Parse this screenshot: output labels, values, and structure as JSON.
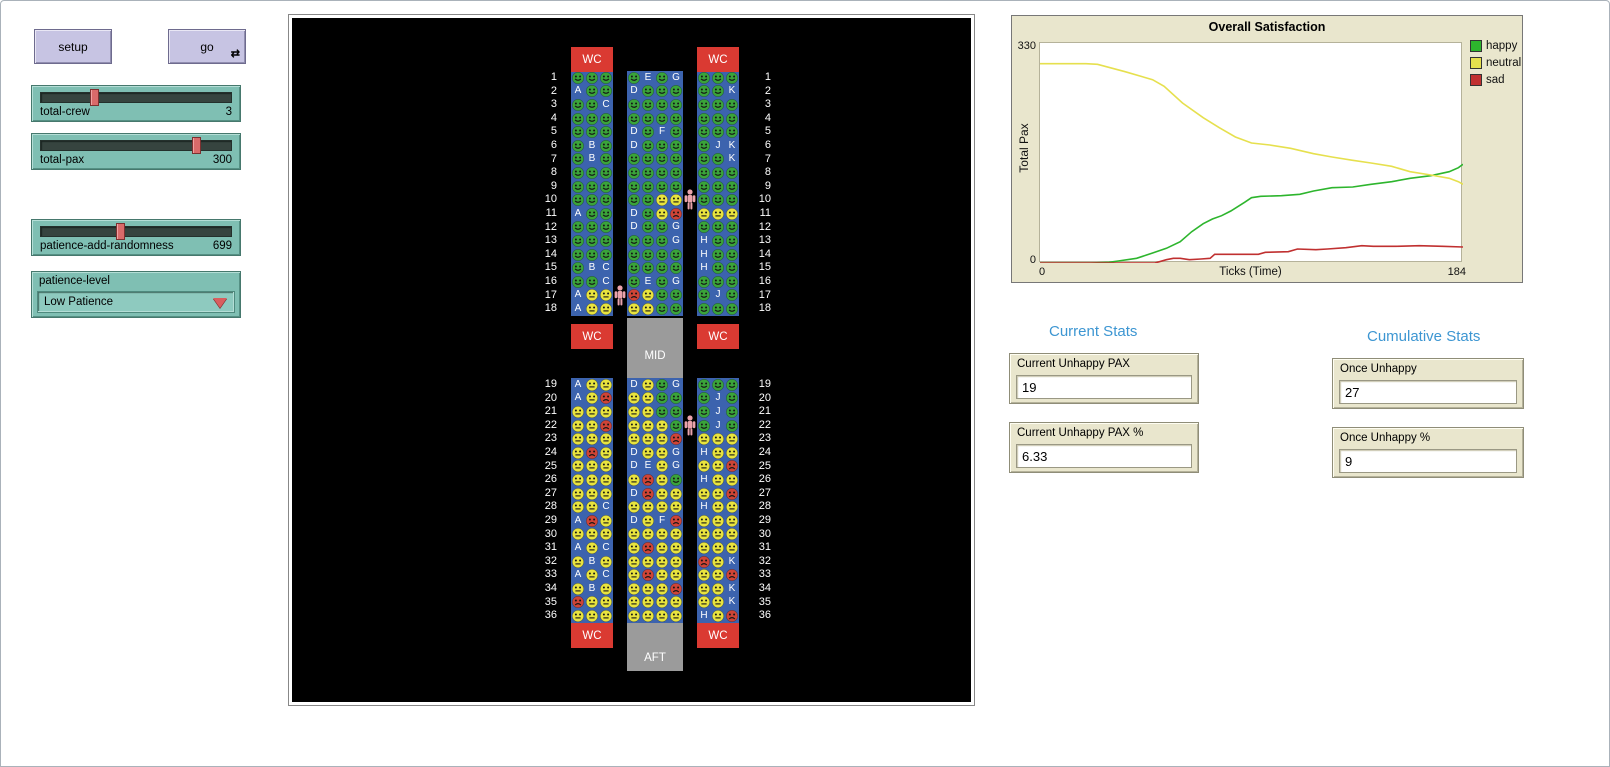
{
  "controls": {
    "setup_label": "setup",
    "go_label": "go",
    "forever_icon": "⇄",
    "sliders": [
      {
        "label": "total-crew",
        "value": "3",
        "pos": 0.27
      },
      {
        "label": "total-pax",
        "value": "300",
        "pos": 0.82
      },
      {
        "label": "patience-add-randomness",
        "value": "699",
        "pos": 0.41
      }
    ],
    "chooser": {
      "label": "patience-level",
      "value": "Low Patience"
    }
  },
  "cabin": {
    "wc_label": "WC",
    "mid_label": "MID",
    "aft_label": "AFT",
    "seat_color": "#3c63ae",
    "state_colors": {
      "h": "#3aa33a",
      "n": "#e8e33e",
      "s": "#cf4436"
    },
    "crew_color": "#eba3ac",
    "crew": [
      {
        "row": 10,
        "aisle": "right"
      },
      {
        "row": 17,
        "aisle": "left"
      },
      {
        "row": 22,
        "aisle": "right"
      }
    ],
    "rows": [
      {
        "n": "1",
        "L": [
          "h",
          "h",
          "h"
        ],
        "M": [
          "h",
          "E",
          "h",
          "G"
        ],
        "R": [
          "h",
          "h",
          "h"
        ]
      },
      {
        "n": "2",
        "L": [
          "A",
          "h",
          "h"
        ],
        "M": [
          "D",
          "h",
          "h",
          "h"
        ],
        "R": [
          "h",
          "h",
          "K"
        ]
      },
      {
        "n": "3",
        "L": [
          "h",
          "h",
          "C"
        ],
        "M": [
          "h",
          "h",
          "h",
          "h"
        ],
        "R": [
          "h",
          "h",
          "h"
        ]
      },
      {
        "n": "4",
        "L": [
          "h",
          "h",
          "h"
        ],
        "M": [
          "h",
          "h",
          "h",
          "h"
        ],
        "R": [
          "h",
          "h",
          "h"
        ]
      },
      {
        "n": "5",
        "L": [
          "h",
          "h",
          "h"
        ],
        "M": [
          "D",
          "h",
          "F",
          "h"
        ],
        "R": [
          "h",
          "h",
          "h"
        ]
      },
      {
        "n": "6",
        "L": [
          "h",
          "B",
          "h"
        ],
        "M": [
          "D",
          "h",
          "h",
          "h"
        ],
        "R": [
          "h",
          "J",
          "K"
        ]
      },
      {
        "n": "7",
        "L": [
          "h",
          "B",
          "h"
        ],
        "M": [
          "h",
          "h",
          "h",
          "h"
        ],
        "R": [
          "h",
          "h",
          "K"
        ]
      },
      {
        "n": "8",
        "L": [
          "h",
          "h",
          "h"
        ],
        "M": [
          "h",
          "h",
          "h",
          "h"
        ],
        "R": [
          "h",
          "h",
          "h"
        ]
      },
      {
        "n": "9",
        "L": [
          "h",
          "h",
          "h"
        ],
        "M": [
          "h",
          "h",
          "h",
          "h"
        ],
        "R": [
          "h",
          "h",
          "h"
        ]
      },
      {
        "n": "10",
        "L": [
          "h",
          "h",
          "h"
        ],
        "M": [
          "h",
          "h",
          "n",
          "n"
        ],
        "R": [
          "h",
          "h",
          "h"
        ]
      },
      {
        "n": "11",
        "L": [
          "A",
          "h",
          "h"
        ],
        "M": [
          "D",
          "h",
          "n",
          "s"
        ],
        "R": [
          "n",
          "n",
          "n"
        ]
      },
      {
        "n": "12",
        "L": [
          "h",
          "h",
          "h"
        ],
        "M": [
          "D",
          "h",
          "h",
          "G"
        ],
        "R": [
          "h",
          "h",
          "h"
        ]
      },
      {
        "n": "13",
        "L": [
          "h",
          "h",
          "h"
        ],
        "M": [
          "h",
          "h",
          "h",
          "G"
        ],
        "R": [
          "H",
          "h",
          "h"
        ]
      },
      {
        "n": "14",
        "L": [
          "h",
          "h",
          "h"
        ],
        "M": [
          "h",
          "h",
          "h",
          "h"
        ],
        "R": [
          "H",
          "h",
          "h"
        ]
      },
      {
        "n": "15",
        "L": [
          "h",
          "B",
          "C"
        ],
        "M": [
          "h",
          "h",
          "h",
          "h"
        ],
        "R": [
          "H",
          "h",
          "h"
        ]
      },
      {
        "n": "16",
        "L": [
          "h",
          "h",
          "C"
        ],
        "M": [
          "h",
          "E",
          "h",
          "G"
        ],
        "R": [
          "h",
          "h",
          "h"
        ]
      },
      {
        "n": "17",
        "L": [
          "A",
          "n",
          "n"
        ],
        "M": [
          "s",
          "n",
          "h",
          "h"
        ],
        "R": [
          "h",
          "J",
          "h"
        ]
      },
      {
        "n": "18",
        "L": [
          "A",
          "n",
          "n"
        ],
        "M": [
          "n",
          "n",
          "h",
          "h"
        ],
        "R": [
          "h",
          "h",
          "h"
        ]
      },
      {
        "n": "19",
        "L": [
          "A",
          "n",
          "n"
        ],
        "M": [
          "D",
          "n",
          "h",
          "G"
        ],
        "R": [
          "h",
          "h",
          "h"
        ]
      },
      {
        "n": "20",
        "L": [
          "A",
          "n",
          "s"
        ],
        "M": [
          "n",
          "n",
          "h",
          "h"
        ],
        "R": [
          "h",
          "J",
          "h"
        ]
      },
      {
        "n": "21",
        "L": [
          "n",
          "n",
          "n"
        ],
        "M": [
          "n",
          "n",
          "h",
          "h"
        ],
        "R": [
          "h",
          "J",
          "h"
        ]
      },
      {
        "n": "22",
        "L": [
          "n",
          "n",
          "s"
        ],
        "M": [
          "n",
          "n",
          "n",
          "h"
        ],
        "R": [
          "h",
          "J",
          "h"
        ]
      },
      {
        "n": "23",
        "L": [
          "n",
          "n",
          "n"
        ],
        "M": [
          "n",
          "n",
          "n",
          "s"
        ],
        "R": [
          "n",
          "n",
          "n"
        ]
      },
      {
        "n": "24",
        "L": [
          "n",
          "s",
          "n"
        ],
        "M": [
          "D",
          "n",
          "n",
          "G"
        ],
        "R": [
          "H",
          "n",
          "n"
        ]
      },
      {
        "n": "25",
        "L": [
          "n",
          "n",
          "n"
        ],
        "M": [
          "D",
          "E",
          "n",
          "G"
        ],
        "R": [
          "n",
          "n",
          "s"
        ]
      },
      {
        "n": "26",
        "L": [
          "n",
          "n",
          "n"
        ],
        "M": [
          "n",
          "s",
          "n",
          "h"
        ],
        "R": [
          "H",
          "n",
          "n"
        ]
      },
      {
        "n": "27",
        "L": [
          "n",
          "n",
          "n"
        ],
        "M": [
          "D",
          "s",
          "n",
          "n"
        ],
        "R": [
          "n",
          "n",
          "s"
        ]
      },
      {
        "n": "28",
        "L": [
          "n",
          "n",
          "C"
        ],
        "M": [
          "n",
          "n",
          "n",
          "n"
        ],
        "R": [
          "H",
          "n",
          "n"
        ]
      },
      {
        "n": "29",
        "L": [
          "A",
          "s",
          "n"
        ],
        "M": [
          "D",
          "n",
          "F",
          "s"
        ],
        "R": [
          "n",
          "n",
          "n"
        ]
      },
      {
        "n": "30",
        "L": [
          "n",
          "n",
          "n"
        ],
        "M": [
          "n",
          "n",
          "n",
          "n"
        ],
        "R": [
          "n",
          "n",
          "n"
        ]
      },
      {
        "n": "31",
        "L": [
          "A",
          "n",
          "C"
        ],
        "M": [
          "n",
          "s",
          "n",
          "n"
        ],
        "R": [
          "n",
          "n",
          "n"
        ]
      },
      {
        "n": "32",
        "L": [
          "n",
          "B",
          "n"
        ],
        "M": [
          "n",
          "n",
          "n",
          "n"
        ],
        "R": [
          "s",
          "n",
          "K"
        ]
      },
      {
        "n": "33",
        "L": [
          "A",
          "n",
          "C"
        ],
        "M": [
          "n",
          "s",
          "n",
          "n"
        ],
        "R": [
          "n",
          "n",
          "s"
        ]
      },
      {
        "n": "34",
        "L": [
          "n",
          "B",
          "n"
        ],
        "M": [
          "n",
          "n",
          "n",
          "s"
        ],
        "R": [
          "n",
          "n",
          "K"
        ]
      },
      {
        "n": "35",
        "L": [
          "s",
          "n",
          "n"
        ],
        "M": [
          "n",
          "n",
          "n",
          "n"
        ],
        "R": [
          "n",
          "n",
          "K"
        ]
      },
      {
        "n": "36",
        "L": [
          "n",
          "n",
          "n"
        ],
        "M": [
          "n",
          "n",
          "n",
          "n"
        ],
        "R": [
          "H",
          "n",
          "s"
        ]
      }
    ]
  },
  "chart_data": {
    "type": "line",
    "title": "Overall Satisfaction",
    "xlabel": "Ticks (Time)",
    "ylabel": "Total Pax",
    "xlim": [
      0,
      184
    ],
    "ylim": [
      0,
      330
    ],
    "x_tick_labels": [
      "0",
      "184"
    ],
    "y_tick_labels": [
      "0",
      "330"
    ],
    "grid": false,
    "legend_position": "right",
    "series": [
      {
        "name": "happy",
        "color": "#2db52d",
        "x": [
          0,
          22,
          30,
          34,
          42,
          49,
          55,
          61,
          66,
          71,
          75,
          79,
          83,
          89,
          92,
          96,
          105,
          113,
          119,
          127,
          136,
          144,
          153,
          161,
          170,
          178,
          182,
          184
        ],
        "y": [
          0,
          0,
          1,
          3,
          7,
          15,
          22,
          32,
          47,
          59,
          66,
          71,
          78,
          91,
          98,
          100,
          101,
          103,
          108,
          113,
          114,
          118,
          122,
          127,
          131,
          137,
          143,
          148
        ]
      },
      {
        "name": "neutral",
        "color": "#e6e04e",
        "x": [
          0,
          20,
          25,
          37,
          49,
          54,
          62,
          71,
          78,
          85,
          92,
          100,
          109,
          119,
          127,
          136,
          144,
          153,
          161,
          170,
          178,
          182,
          184
        ],
        "y": [
          299,
          299,
          298,
          287,
          275,
          265,
          240,
          218,
          203,
          189,
          180,
          177,
          172,
          164,
          159,
          154,
          150,
          145,
          137,
          132,
          127,
          122,
          118
        ]
      },
      {
        "name": "sad",
        "color": "#c03030",
        "x": [
          0,
          50,
          55,
          58,
          61,
          65,
          70,
          74,
          76,
          95,
          98,
          108,
          112,
          120,
          125,
          133,
          140,
          145,
          155,
          165,
          175,
          184
        ],
        "y": [
          0,
          0,
          5,
          7,
          7,
          5,
          6,
          7,
          13,
          13,
          16,
          17,
          21,
          20,
          21,
          23,
          26,
          25,
          25,
          26,
          25,
          24
        ]
      }
    ]
  },
  "stats": {
    "current_heading": "Current Stats",
    "cumulative_heading": "Cumulative Stats",
    "monitors": [
      {
        "label": "Current Unhappy PAX",
        "value": "19"
      },
      {
        "label": "Current Unhappy PAX %",
        "value": "6.33"
      },
      {
        "label": "Once Unhappy",
        "value": "27"
      },
      {
        "label": "Once Unhappy %",
        "value": "9"
      }
    ]
  }
}
